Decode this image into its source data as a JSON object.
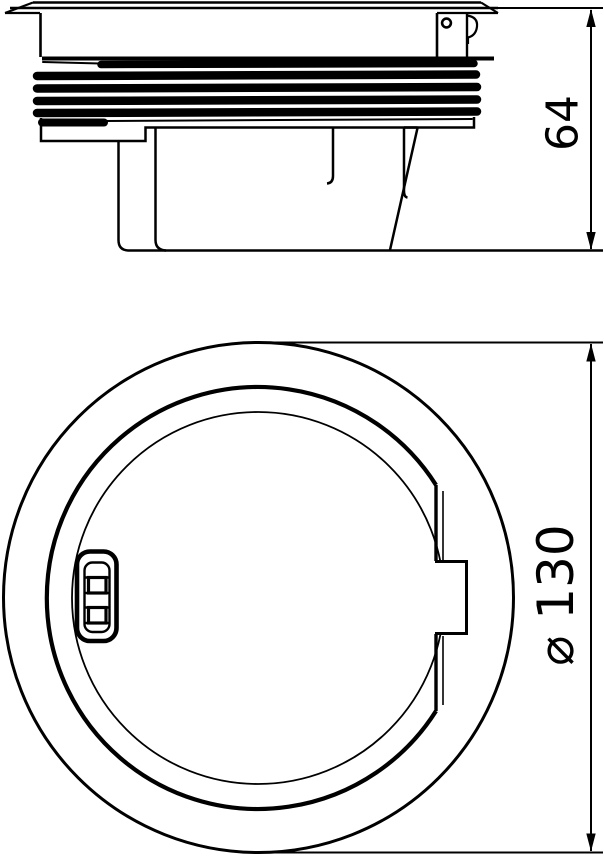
{
  "page": {
    "background": "#ffffff",
    "line_color": "#000000"
  },
  "drawing": {
    "type": "technical-drawing",
    "views": [
      {
        "id": "side",
        "name": "side elevation view"
      },
      {
        "id": "top",
        "name": "top plan view"
      }
    ],
    "dimensions": {
      "height": {
        "label": "64"
      },
      "diameter": {
        "label": "⌀ 130"
      }
    }
  }
}
